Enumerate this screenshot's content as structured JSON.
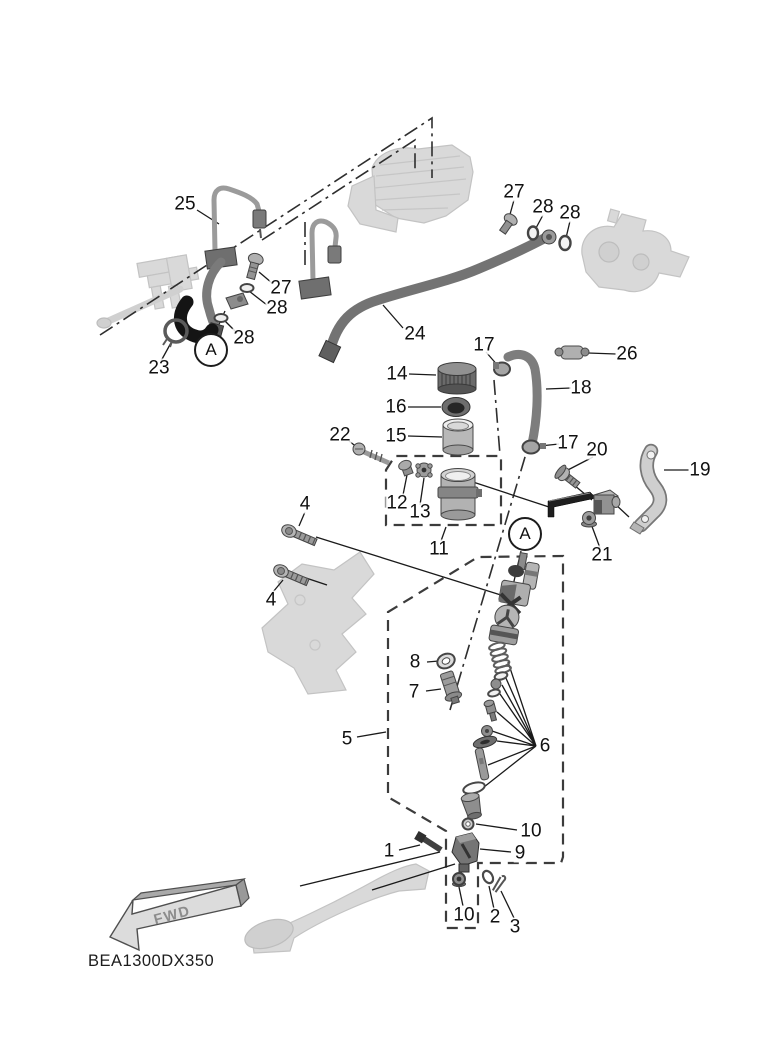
{
  "diagram": {
    "code": "BEA1300DX350",
    "fwd_label": "FWD",
    "detail_marker": "A",
    "colors": {
      "background": "#ffffff",
      "line_color": "#1a1a1a",
      "label_color": "#111111",
      "ghost_color": "#d9d9d9",
      "part_color": "#9a9a9a",
      "dark_part_color": "#1e1e1e"
    },
    "callouts": [
      {
        "label": "25",
        "x": 185,
        "y": 204
      },
      {
        "label": "27",
        "x": 514,
        "y": 192
      },
      {
        "label": "28",
        "x": 543,
        "y": 207
      },
      {
        "label": "28",
        "x": 570,
        "y": 213
      },
      {
        "label": "27",
        "x": 281,
        "y": 288
      },
      {
        "label": "28",
        "x": 277,
        "y": 308
      },
      {
        "label": "28",
        "x": 244,
        "y": 338
      },
      {
        "label": "23",
        "x": 159,
        "y": 368
      },
      {
        "label": "24",
        "x": 415,
        "y": 334
      },
      {
        "label": "17",
        "x": 484,
        "y": 345
      },
      {
        "label": "26",
        "x": 627,
        "y": 354
      },
      {
        "label": "14",
        "x": 397,
        "y": 374
      },
      {
        "label": "18",
        "x": 581,
        "y": 388
      },
      {
        "label": "16",
        "x": 396,
        "y": 407
      },
      {
        "label": "15",
        "x": 396,
        "y": 436
      },
      {
        "label": "22",
        "x": 340,
        "y": 435
      },
      {
        "label": "17",
        "x": 568,
        "y": 443
      },
      {
        "label": "20",
        "x": 597,
        "y": 450
      },
      {
        "label": "19",
        "x": 700,
        "y": 470
      },
      {
        "label": "12",
        "x": 397,
        "y": 503
      },
      {
        "label": "13",
        "x": 420,
        "y": 512
      },
      {
        "label": "4",
        "x": 305,
        "y": 504
      },
      {
        "label": "11",
        "x": 439,
        "y": 549
      },
      {
        "label": "21",
        "x": 602,
        "y": 555
      },
      {
        "label": "4",
        "x": 271,
        "y": 600
      },
      {
        "label": "8",
        "x": 415,
        "y": 662
      },
      {
        "label": "7",
        "x": 414,
        "y": 692
      },
      {
        "label": "5",
        "x": 347,
        "y": 739
      },
      {
        "label": "6",
        "x": 545,
        "y": 746
      },
      {
        "label": "10",
        "x": 531,
        "y": 831
      },
      {
        "label": "1",
        "x": 389,
        "y": 851
      },
      {
        "label": "9",
        "x": 520,
        "y": 853
      },
      {
        "label": "10",
        "x": 464,
        "y": 915
      },
      {
        "label": "2",
        "x": 495,
        "y": 917
      },
      {
        "label": "3",
        "x": 515,
        "y": 927
      }
    ],
    "bubbles": [
      {
        "label": "A",
        "x": 211,
        "y": 350
      },
      {
        "label": "A",
        "x": 525,
        "y": 534
      }
    ]
  }
}
